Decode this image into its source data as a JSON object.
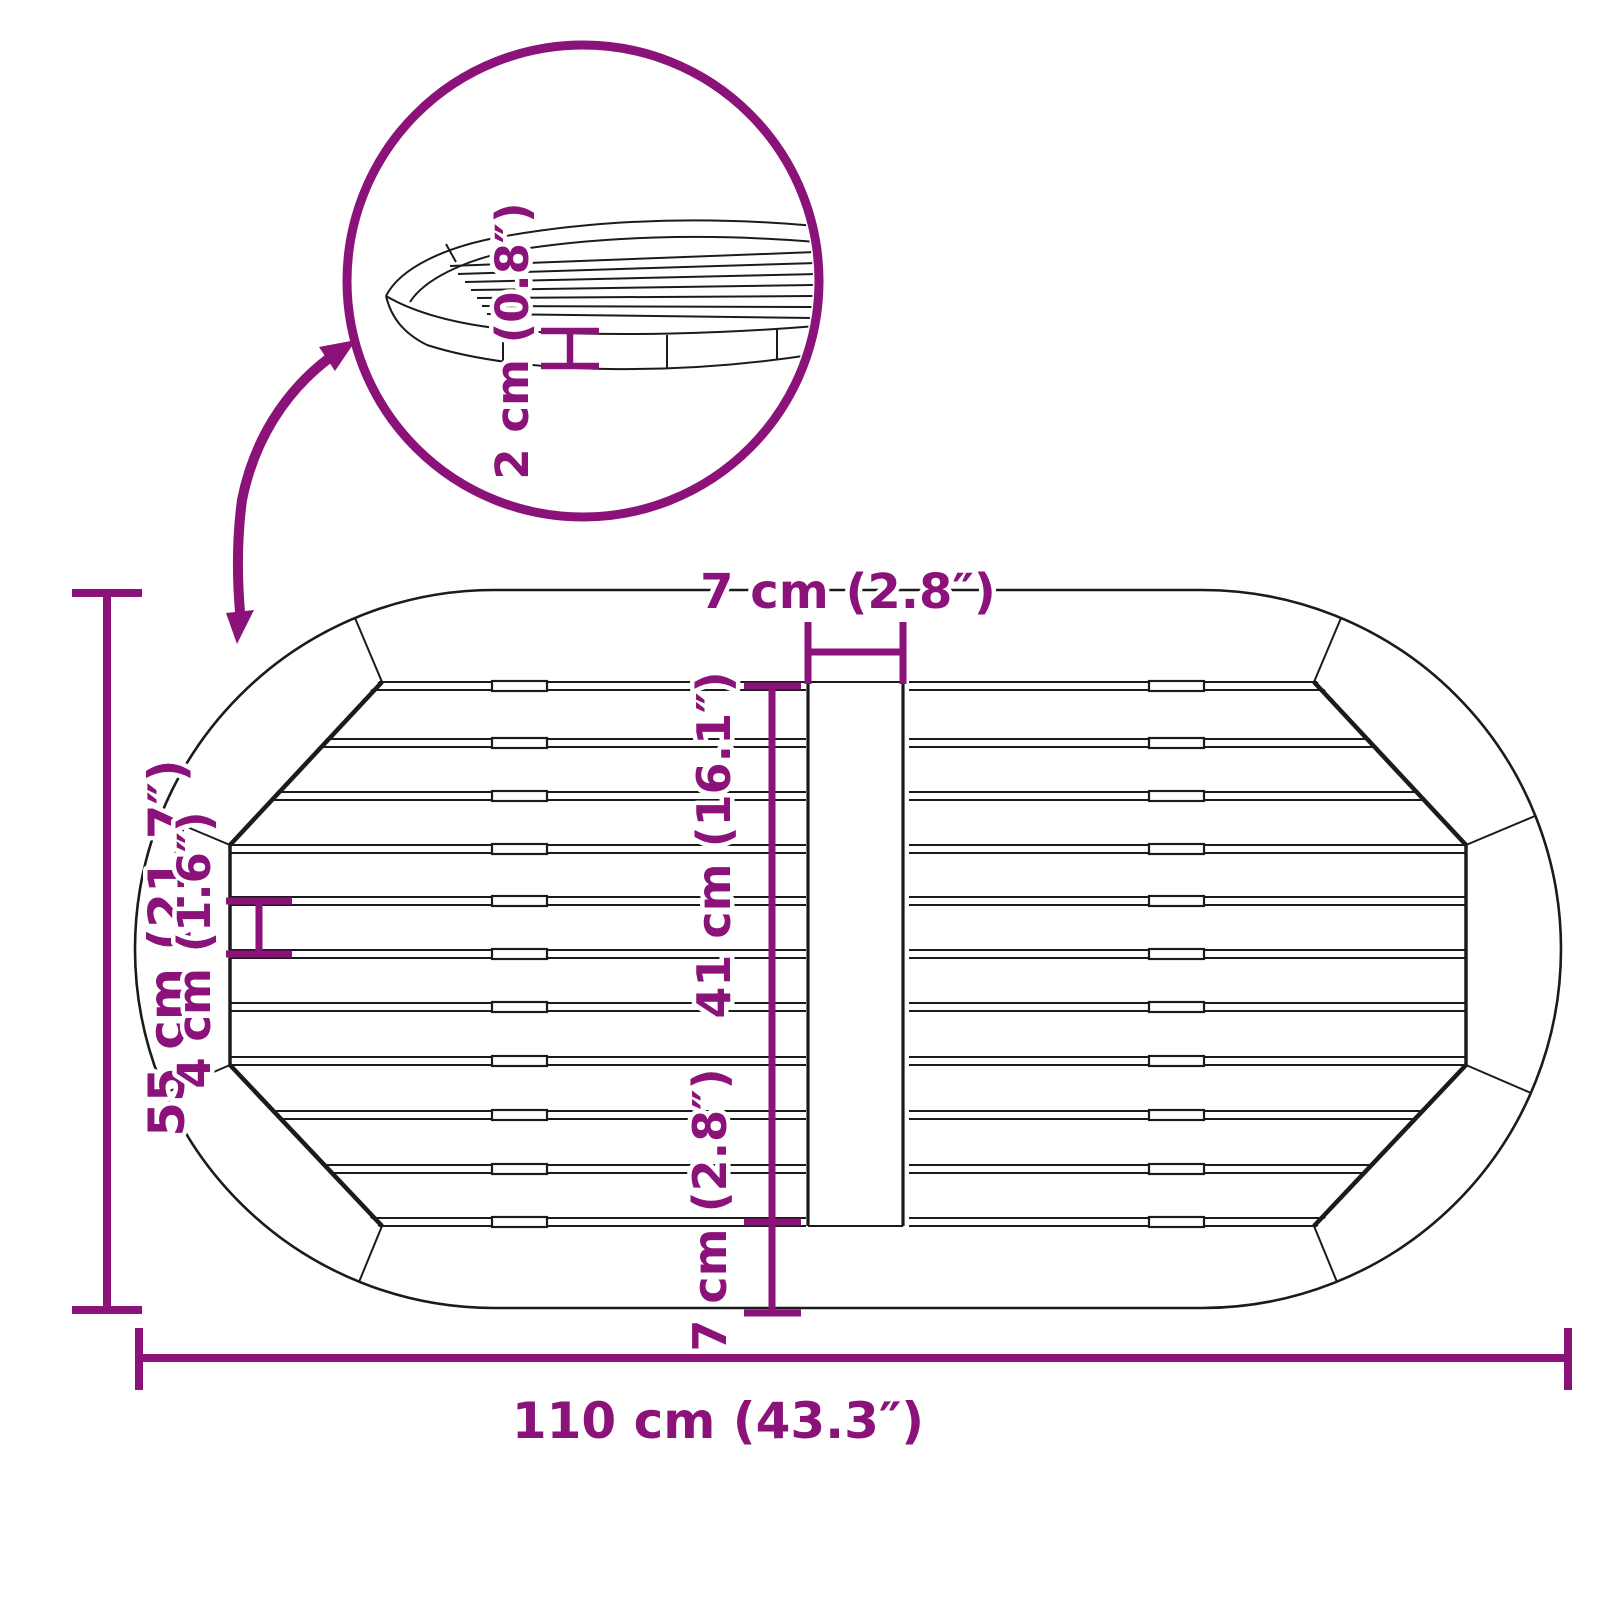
{
  "diagram": {
    "type": "product-dimension-diagram",
    "subject": "oval slatted garden table top, top view with magnified edge detail",
    "colors": {
      "dimension_accent": "#8A1278",
      "outline": "#1b1b1b",
      "background": "#ffffff"
    }
  },
  "labels": {
    "total_width": "110 cm (43.3″)",
    "total_height": "55 cm (21.7″)",
    "slat_area_height": "41 cm (16.1″)",
    "bottom_rim_width": "7 cm (2.8″)",
    "center_strip_width": "7 cm (2.8″)",
    "slat_width": "4 cm (1.6″)",
    "top_thickness": "2 cm (0.8″)"
  }
}
